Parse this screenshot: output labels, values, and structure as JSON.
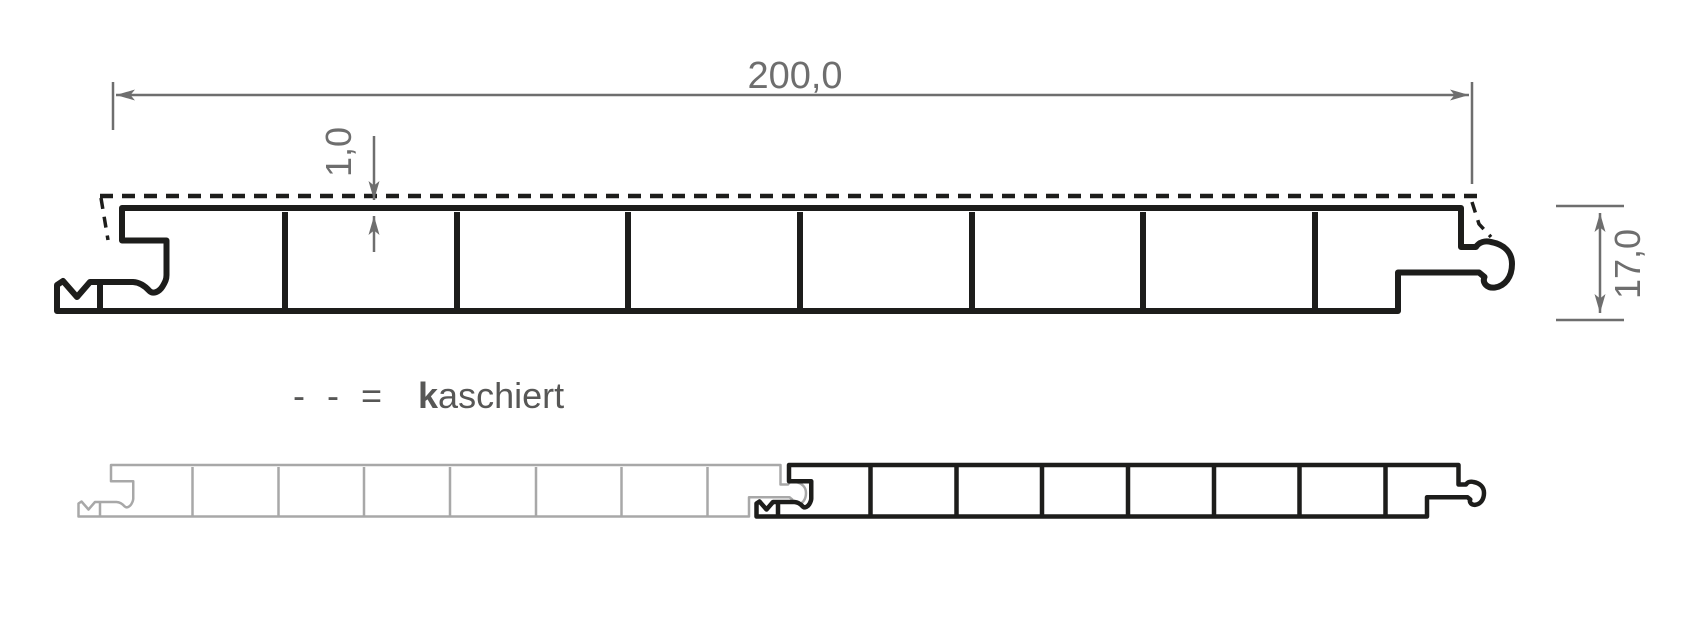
{
  "colors": {
    "ink": "#1d1d1b",
    "dim_gray": "#6e6e6e",
    "panel_gray": "#a8a8a8",
    "legend_gray": "#575756",
    "paper": "#ffffff"
  },
  "dimensions": {
    "width": "200,0",
    "lamination": "1,0",
    "height": "17,0"
  },
  "legend": {
    "symbol": "- - = ",
    "term_bold": "k",
    "term_rest": "aschiert"
  }
}
